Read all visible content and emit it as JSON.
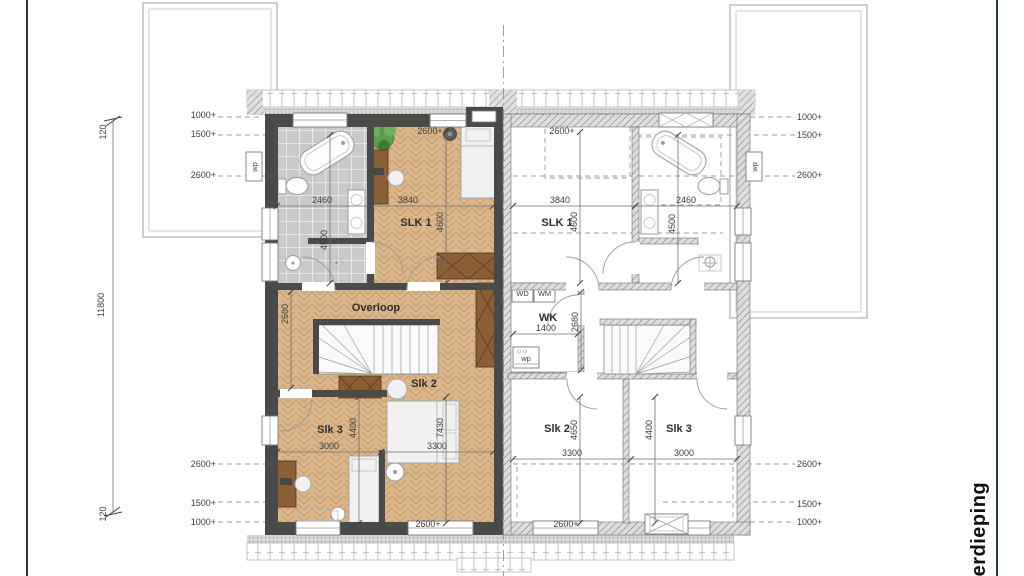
{
  "sheet": {
    "floor_label": "verdieping"
  },
  "margins": {
    "overall_height": "11800",
    "offset_top": "120",
    "offset_bottom": "120",
    "wp_left": "wp",
    "wp_right": "wp",
    "left_top": [
      "1000+",
      "1500+",
      "2600+"
    ],
    "left_bottom": [
      "2600+",
      "1500+",
      "1000+"
    ],
    "right_top": [
      "1000+",
      "1500+",
      "2600+"
    ],
    "right_bottom": [
      "2600+",
      "1500+",
      "1000+"
    ]
  },
  "left_house": {
    "rooms": {
      "slk1": "SLK 1",
      "overloop": "Overloop",
      "slk2": "Slk 2",
      "slk3": "Slk 3"
    },
    "dims": {
      "w_bath": "2460",
      "w_slk1": "3840",
      "h_slk1": "4600",
      "h_bath": "4500",
      "ceil_top": "2600+",
      "h_overloop": "2680",
      "w_slk3": "3000",
      "h_slk3": "4400",
      "w_slk2": "3300",
      "h_slk2": "7430",
      "ceil_bottom": "2600+"
    }
  },
  "right_house": {
    "rooms": {
      "slk1": "SLK 1",
      "wk": "WK",
      "wd": "WD",
      "wm": "WM",
      "slk2": "Slk 2",
      "slk3": "Slk 3",
      "wp_unit": "wp"
    },
    "dims": {
      "w_slk1": "3840",
      "w_bath": "2460",
      "h_slk1": "4600",
      "h_bath": "4500",
      "ceil_top": "2600+",
      "h_overloop": "2680",
      "w_wk": "1400",
      "w_slk2": "3300",
      "h_slk2": "4650",
      "w_slk3": "3000",
      "h_slk3": "4400",
      "ceil_bottom": "2600+"
    }
  },
  "colors": {
    "wall": "#4a4a48",
    "wood": "#dbb68c",
    "woodline": "#c49c6c",
    "tile": "#c9c9c9",
    "accent": "#8b5e36",
    "border": "#2b3947",
    "plant": "#5a9e4a"
  }
}
